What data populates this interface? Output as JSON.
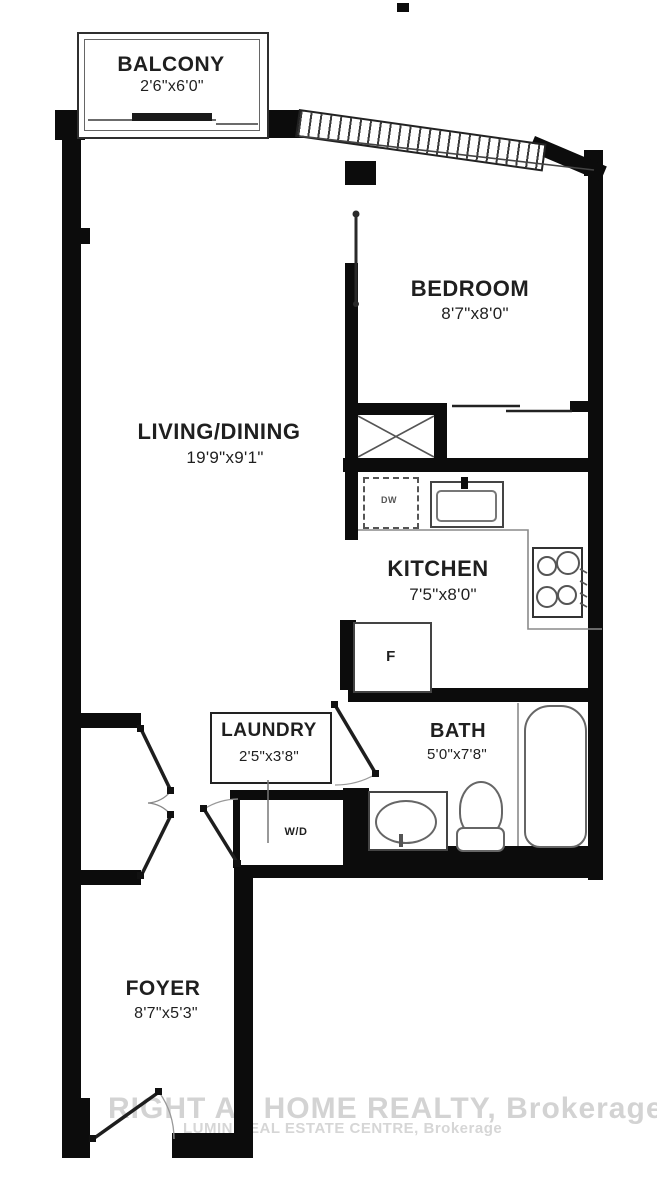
{
  "plan": {
    "type": "condo floor plan",
    "rooms": {
      "balcony": {
        "name": "BALCONY",
        "dims": "2'6\"x6'0\""
      },
      "bedroom": {
        "name": "BEDROOM",
        "dims": "8'7\"x8'0\""
      },
      "living_dining": {
        "name": "LIVING/DINING",
        "dims": "19'9\"x9'1\""
      },
      "kitchen": {
        "name": "KITCHEN",
        "dims": "7'5\"x8'0\""
      },
      "laundry": {
        "name": "LAUNDRY",
        "dims": "2'5\"x3'8\""
      },
      "bath": {
        "name": "BATH",
        "dims": "5'0\"x7'8\""
      },
      "foyer": {
        "name": "FOYER",
        "dims": "8'7\"x5'3\""
      }
    },
    "fixtures": {
      "washer_dryer": "W/D",
      "fridge": "F",
      "dishwasher": "DW"
    },
    "watermark": {
      "line1": "RIGHT AT HOME REALTY, Brokerage",
      "line2": "LUMIN REAL ESTATE CENTRE, Brokerage"
    },
    "colors": {
      "wall": "#0c0c0c",
      "fixture_line": "#555555",
      "text": "#1f1f1f",
      "watermark_large": "#cccccc",
      "watermark_small": "#d9d9d9"
    }
  }
}
